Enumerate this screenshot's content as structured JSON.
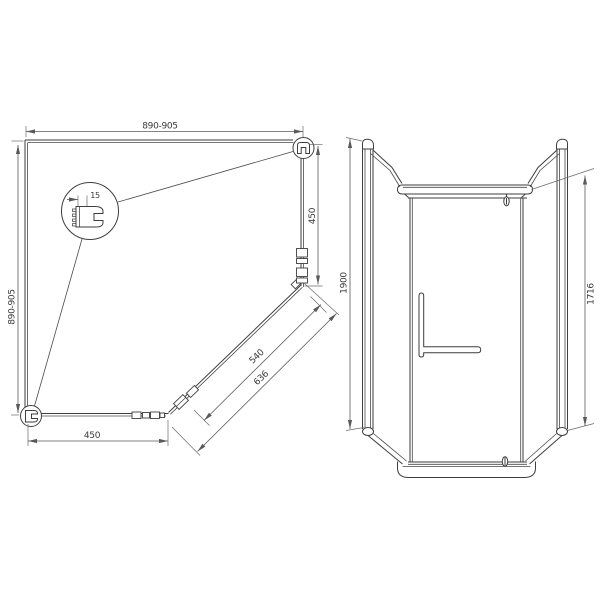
{
  "drawing": {
    "kind": "technical-drawing",
    "subject": "pentagonal shower enclosure",
    "views": {
      "plan": {
        "dims": {
          "top_width": "890-905",
          "left_depth": "890-905",
          "right_wall_segment": "450",
          "bottom_wall_segment": "450",
          "door_glass": "540",
          "door_overall": "636",
          "detail_profile": "15"
        }
      },
      "front": {
        "dims": {
          "total_height": "1900",
          "door_height": "1716"
        }
      }
    },
    "colors": {
      "background": "#ffffff",
      "object_line": "#3e3e3e",
      "dimension_line": "#5a5a5a",
      "text": "#3a3a3a"
    }
  }
}
